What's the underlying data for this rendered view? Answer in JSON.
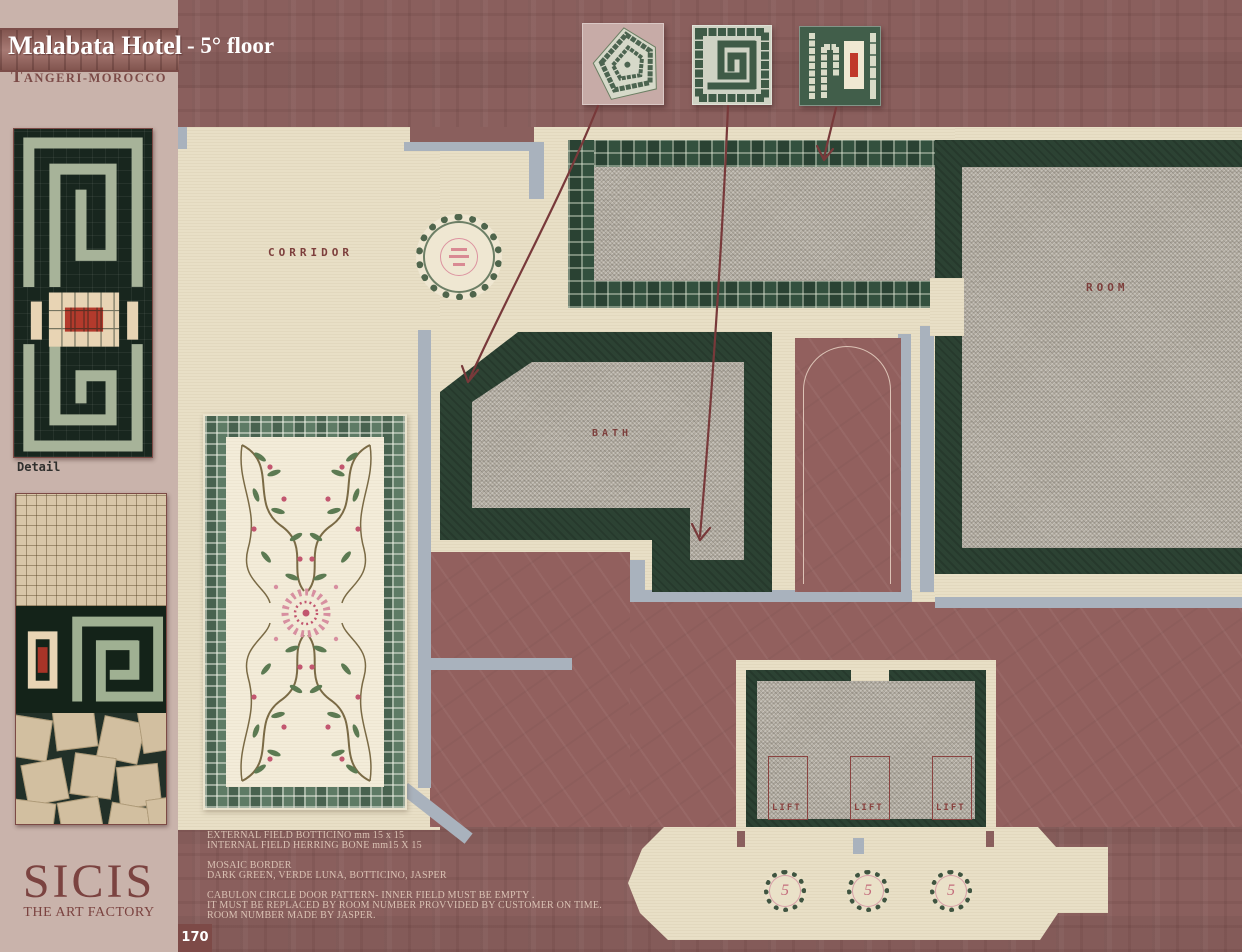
{
  "header": {
    "hotel": "Malabata Hotel",
    "floor": "-  5° floor",
    "location": "Tangeri-morocco"
  },
  "sidebar": {
    "detail_caption": "Detail",
    "brand": "SICIS",
    "brand_sub": "THE ART FACTORY"
  },
  "plan": {
    "corridor": "CORRIDOR",
    "room": "ROOM",
    "bath": "BATH",
    "lifts": [
      "LIFT",
      "LIFT",
      "LIFT"
    ],
    "door_medallions": [
      "5",
      "5",
      "5"
    ]
  },
  "notes": {
    "lines": [
      "EXTERNAL FIELD  BOTTICINO mm 15 x 15",
      "INTERNAL FIELD HERRING BONE mm15 X 15",
      "MOSAIC BORDER",
      "DARK GREEN, VERDE LUNA, BOTTICINO, JASPER",
      "CABULON CIRCLE DOOR PATTERN- INNER FIELD MUST BE EMPTY .",
      "IT MUST BE REPLACED BY ROOM NUMBER PROVVIDED BY CUSTOMER ON TIME.",
      "ROOM NUMBER MADE BY JASPER."
    ]
  },
  "page": {
    "number": "170"
  },
  "colors": {
    "page_maroon": "#8a5f5d",
    "sidebar_pink": "#c9b3ab",
    "floor_cream": "#e8dfc6",
    "wall_grey": "#a9b2bd",
    "mosaic_dark_green": "#2c4233",
    "field_grey": "#b5afa4",
    "label_maroon": "#7d3f3c",
    "note_text": "#dac2b4",
    "accent_red": "#b33a2c",
    "accent_pink": "#c46d7c"
  }
}
